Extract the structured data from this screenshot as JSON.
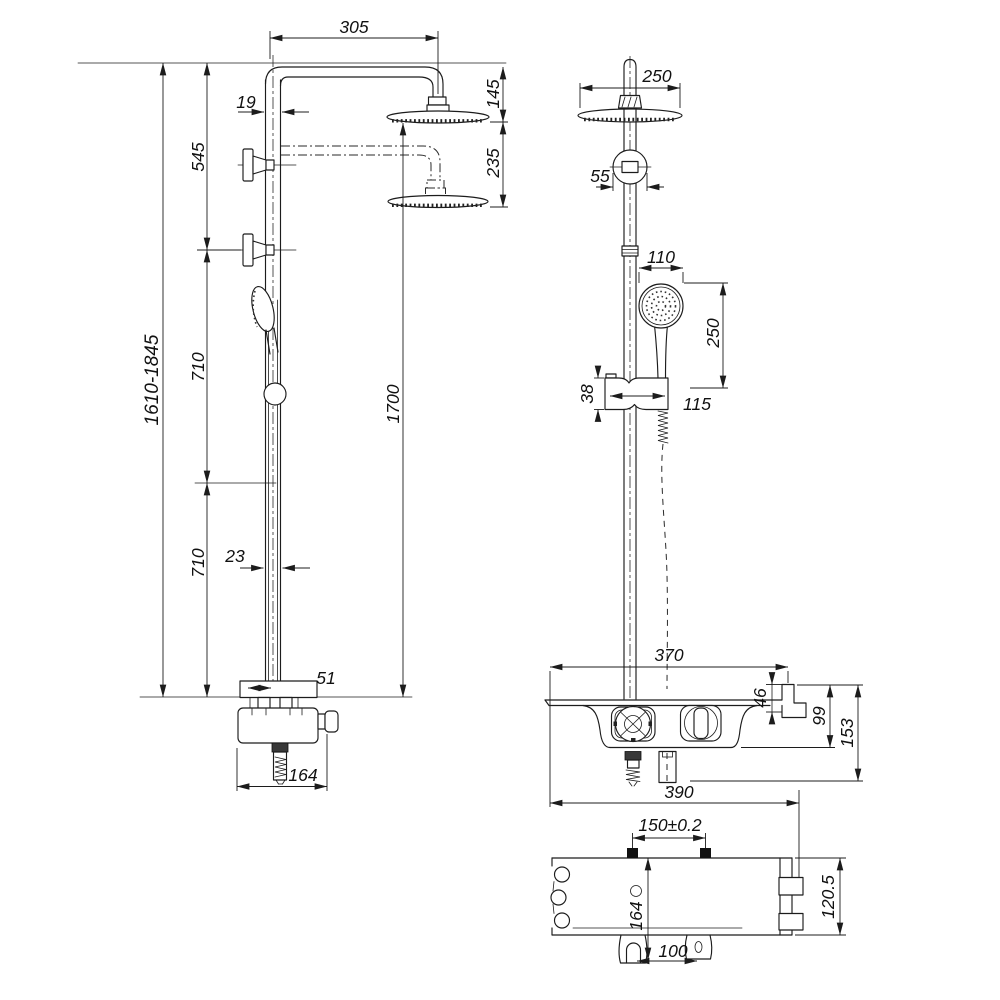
{
  "labels": {
    "side_view": {
      "arm_reach": "305",
      "upper_pipe_width": "19",
      "bracket_span": "545",
      "height_range": "1610-1845",
      "top_head_drop": "145",
      "head_spacing": "235",
      "mid_segment": "710",
      "lower_segment": "710",
      "lower_pipe_width": "23",
      "column_height": "1700",
      "spout_offset": "51",
      "valve_depth": "164"
    },
    "front_view": {
      "overhead_diameter": "250",
      "escutcheon_width": "55",
      "handshower_diameter": "110",
      "handshower_drop": "250",
      "slider_height": "38",
      "slider_width": "115",
      "valve_width": "370",
      "hook_height": "46",
      "body_height": "99",
      "total_height": "153",
      "overall_width": "390"
    },
    "bottom_view": {
      "mount_spacing": "150±0.2",
      "depth": "164",
      "outlet_spacing": "100",
      "overall_depth": "120.5"
    }
  }
}
